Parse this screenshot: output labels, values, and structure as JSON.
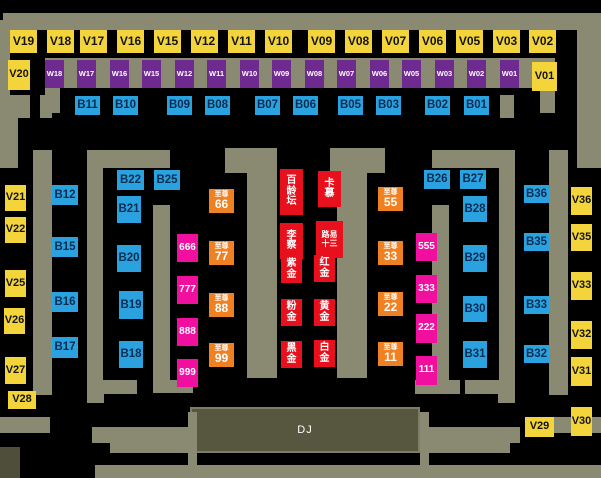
{
  "dj_booth": {
    "label": "DJ"
  },
  "colors": {
    "background": "#000000",
    "wall": "#8a8a73",
    "vip_yellow": "#f3d43b",
    "w_purple": "#6e2a8e",
    "b_blue": "#2aa2e0",
    "pink_magenta": "#f00f9e",
    "supreme_orange": "#f08122",
    "booth_red": "#e8101c",
    "dj_fill": "#57573f"
  },
  "tables": [
    {
      "label": "V19",
      "type": "vip",
      "x": 10,
      "y": 30,
      "w": 27,
      "h": 23
    },
    {
      "label": "V18",
      "type": "vip",
      "x": 47,
      "y": 30,
      "w": 27,
      "h": 23
    },
    {
      "label": "V17",
      "type": "vip",
      "x": 80,
      "y": 30,
      "w": 27,
      "h": 23
    },
    {
      "label": "V16",
      "type": "vip",
      "x": 117,
      "y": 30,
      "w": 27,
      "h": 23
    },
    {
      "label": "V15",
      "type": "vip",
      "x": 154,
      "y": 30,
      "w": 27,
      "h": 23
    },
    {
      "label": "V12",
      "type": "vip",
      "x": 191,
      "y": 30,
      "w": 27,
      "h": 23
    },
    {
      "label": "V11",
      "type": "vip",
      "x": 228,
      "y": 30,
      "w": 27,
      "h": 23
    },
    {
      "label": "V10",
      "type": "vip",
      "x": 265,
      "y": 30,
      "w": 27,
      "h": 23
    },
    {
      "label": "V09",
      "type": "vip",
      "x": 308,
      "y": 30,
      "w": 27,
      "h": 23
    },
    {
      "label": "V08",
      "type": "vip",
      "x": 345,
      "y": 30,
      "w": 27,
      "h": 23
    },
    {
      "label": "V07",
      "type": "vip",
      "x": 382,
      "y": 30,
      "w": 27,
      "h": 23
    },
    {
      "label": "V06",
      "type": "vip",
      "x": 419,
      "y": 30,
      "w": 27,
      "h": 23
    },
    {
      "label": "V05",
      "type": "vip",
      "x": 456,
      "y": 30,
      "w": 27,
      "h": 23
    },
    {
      "label": "V03",
      "type": "vip",
      "x": 493,
      "y": 30,
      "w": 27,
      "h": 23
    },
    {
      "label": "V02",
      "type": "vip",
      "x": 529,
      "y": 30,
      "w": 27,
      "h": 23
    },
    {
      "label": "V20",
      "type": "vips",
      "x": 8,
      "y": 60,
      "w": 22,
      "h": 30
    },
    {
      "label": "V01",
      "type": "vips",
      "x": 532,
      "y": 62,
      "w": 25,
      "h": 29
    },
    {
      "label": "W18",
      "type": "w",
      "x": 45,
      "y": 60,
      "w": 19,
      "h": 28
    },
    {
      "label": "W17",
      "type": "w",
      "x": 77,
      "y": 60,
      "w": 19,
      "h": 28
    },
    {
      "label": "W16",
      "type": "w",
      "x": 110,
      "y": 60,
      "w": 19,
      "h": 28
    },
    {
      "label": "W15",
      "type": "w",
      "x": 142,
      "y": 60,
      "w": 19,
      "h": 28
    },
    {
      "label": "W12",
      "type": "w",
      "x": 175,
      "y": 60,
      "w": 19,
      "h": 28
    },
    {
      "label": "W11",
      "type": "w",
      "x": 207,
      "y": 60,
      "w": 19,
      "h": 28
    },
    {
      "label": "W10",
      "type": "w",
      "x": 240,
      "y": 60,
      "w": 19,
      "h": 28
    },
    {
      "label": "W09",
      "type": "w",
      "x": 272,
      "y": 60,
      "w": 19,
      "h": 28
    },
    {
      "label": "W08",
      "type": "w",
      "x": 305,
      "y": 60,
      "w": 19,
      "h": 28
    },
    {
      "label": "W07",
      "type": "w",
      "x": 337,
      "y": 60,
      "w": 19,
      "h": 28
    },
    {
      "label": "W06",
      "type": "w",
      "x": 370,
      "y": 60,
      "w": 19,
      "h": 28
    },
    {
      "label": "W05",
      "type": "w",
      "x": 402,
      "y": 60,
      "w": 19,
      "h": 28
    },
    {
      "label": "W03",
      "type": "w",
      "x": 435,
      "y": 60,
      "w": 19,
      "h": 28
    },
    {
      "label": "W02",
      "type": "w",
      "x": 467,
      "y": 60,
      "w": 19,
      "h": 28
    },
    {
      "label": "W01",
      "type": "w",
      "x": 500,
      "y": 60,
      "w": 19,
      "h": 28
    },
    {
      "label": "B11",
      "type": "b",
      "x": 75,
      "y": 96,
      "w": 25,
      "h": 19
    },
    {
      "label": "B10",
      "type": "b",
      "x": 113,
      "y": 96,
      "w": 25,
      "h": 19
    },
    {
      "label": "B09",
      "type": "b",
      "x": 167,
      "y": 96,
      "w": 25,
      "h": 19
    },
    {
      "label": "B08",
      "type": "b",
      "x": 205,
      "y": 96,
      "w": 25,
      "h": 19
    },
    {
      "label": "B07",
      "type": "b",
      "x": 255,
      "y": 96,
      "w": 25,
      "h": 19
    },
    {
      "label": "B06",
      "type": "b",
      "x": 293,
      "y": 96,
      "w": 25,
      "h": 19
    },
    {
      "label": "B05",
      "type": "b",
      "x": 338,
      "y": 96,
      "w": 25,
      "h": 19
    },
    {
      "label": "B03",
      "type": "b",
      "x": 376,
      "y": 96,
      "w": 25,
      "h": 19
    },
    {
      "label": "B02",
      "type": "b",
      "x": 425,
      "y": 96,
      "w": 25,
      "h": 19
    },
    {
      "label": "B01",
      "type": "b",
      "x": 464,
      "y": 96,
      "w": 25,
      "h": 19
    },
    {
      "label": "V21",
      "type": "vips",
      "x": 5,
      "y": 185,
      "w": 21,
      "h": 26
    },
    {
      "label": "V22",
      "type": "vips",
      "x": 5,
      "y": 217,
      "w": 21,
      "h": 26
    },
    {
      "label": "V25",
      "type": "vips",
      "x": 5,
      "y": 270,
      "w": 21,
      "h": 27
    },
    {
      "label": "V26",
      "type": "vips",
      "x": 4,
      "y": 308,
      "w": 21,
      "h": 26
    },
    {
      "label": "V27",
      "type": "vips",
      "x": 5,
      "y": 357,
      "w": 21,
      "h": 27
    },
    {
      "label": "V28",
      "type": "vips",
      "x": 8,
      "y": 391,
      "w": 28,
      "h": 18
    },
    {
      "label": "B12",
      "type": "b",
      "x": 52,
      "y": 185,
      "w": 26,
      "h": 20
    },
    {
      "label": "B15",
      "type": "b",
      "x": 52,
      "y": 237,
      "w": 26,
      "h": 20
    },
    {
      "label": "B16",
      "type": "b",
      "x": 52,
      "y": 292,
      "w": 26,
      "h": 20
    },
    {
      "label": "B17",
      "type": "b",
      "x": 52,
      "y": 337,
      "w": 26,
      "h": 21
    },
    {
      "label": "B22",
      "type": "b",
      "x": 117,
      "y": 170,
      "w": 27,
      "h": 20
    },
    {
      "label": "B25",
      "type": "b",
      "x": 154,
      "y": 170,
      "w": 26,
      "h": 20
    },
    {
      "label": "B21",
      "type": "b",
      "x": 117,
      "y": 196,
      "w": 24,
      "h": 27
    },
    {
      "label": "B20",
      "type": "b",
      "x": 117,
      "y": 245,
      "w": 24,
      "h": 27
    },
    {
      "label": "B19",
      "type": "b",
      "x": 119,
      "y": 291,
      "w": 24,
      "h": 28
    },
    {
      "label": "B18",
      "type": "b",
      "x": 119,
      "y": 341,
      "w": 24,
      "h": 27
    },
    {
      "label": "666",
      "type": "pink",
      "x": 177,
      "y": 234,
      "w": 21,
      "h": 28
    },
    {
      "label": "777",
      "type": "pink",
      "x": 177,
      "y": 276,
      "w": 21,
      "h": 28
    },
    {
      "label": "888",
      "type": "pink",
      "x": 177,
      "y": 318,
      "w": 21,
      "h": 28
    },
    {
      "label": "999",
      "type": "pink",
      "x": 177,
      "y": 359,
      "w": 21,
      "h": 28
    },
    {
      "label": "至尊66",
      "type": "sup",
      "prefix": "至尊",
      "num": "66",
      "x": 209,
      "y": 189,
      "w": 25,
      "h": 24
    },
    {
      "label": "至尊77",
      "type": "sup",
      "prefix": "至尊",
      "num": "77",
      "x": 209,
      "y": 241,
      "w": 25,
      "h": 24
    },
    {
      "label": "至尊88",
      "type": "sup",
      "prefix": "至尊",
      "num": "88",
      "x": 209,
      "y": 293,
      "w": 25,
      "h": 24
    },
    {
      "label": "至尊99",
      "type": "sup",
      "prefix": "至尊",
      "num": "99",
      "x": 209,
      "y": 343,
      "w": 25,
      "h": 24
    },
    {
      "label": "百龄坛",
      "type": "red",
      "lines": [
        "百",
        "龄",
        "坛"
      ],
      "x": 280,
      "y": 169,
      "w": 23,
      "h": 46
    },
    {
      "label": "卡慕",
      "type": "red",
      "lines": [
        "卡",
        "慕"
      ],
      "x": 318,
      "y": 171,
      "w": 23,
      "h": 36
    },
    {
      "label": "李察",
      "type": "red",
      "lines": [
        "李",
        "察"
      ],
      "x": 280,
      "y": 223,
      "w": 23,
      "h": 36
    },
    {
      "label": "路易十三",
      "type": "red small",
      "lines": [
        "路易",
        "十三"
      ],
      "x": 316,
      "y": 221,
      "w": 27,
      "h": 37
    },
    {
      "label": "紫金",
      "type": "red",
      "lines": [
        "紫",
        "金"
      ],
      "x": 281,
      "y": 256,
      "w": 21,
      "h": 27
    },
    {
      "label": "红金",
      "type": "red",
      "lines": [
        "红",
        "金"
      ],
      "x": 314,
      "y": 255,
      "w": 21,
      "h": 27
    },
    {
      "label": "粉金",
      "type": "red",
      "lines": [
        "粉",
        "金"
      ],
      "x": 281,
      "y": 299,
      "w": 21,
      "h": 27
    },
    {
      "label": "黄金",
      "type": "red",
      "lines": [
        "黄",
        "金"
      ],
      "x": 314,
      "y": 299,
      "w": 21,
      "h": 27
    },
    {
      "label": "黑金",
      "type": "red",
      "lines": [
        "黑",
        "金"
      ],
      "x": 281,
      "y": 341,
      "w": 21,
      "h": 27
    },
    {
      "label": "白金",
      "type": "red",
      "lines": [
        "白",
        "金"
      ],
      "x": 314,
      "y": 340,
      "w": 21,
      "h": 27
    },
    {
      "label": "至尊55",
      "type": "sup",
      "prefix": "至尊",
      "num": "55",
      "x": 378,
      "y": 187,
      "w": 25,
      "h": 24
    },
    {
      "label": "至尊33",
      "type": "sup",
      "prefix": "至尊",
      "num": "33",
      "x": 378,
      "y": 241,
      "w": 25,
      "h": 24
    },
    {
      "label": "至尊22",
      "type": "sup",
      "prefix": "至尊",
      "num": "22",
      "x": 378,
      "y": 292,
      "w": 25,
      "h": 24
    },
    {
      "label": "至尊11",
      "type": "sup",
      "prefix": "至尊",
      "num": "11",
      "x": 378,
      "y": 342,
      "w": 25,
      "h": 24
    },
    {
      "label": "555",
      "type": "pink",
      "x": 416,
      "y": 233,
      "w": 21,
      "h": 28
    },
    {
      "label": "333",
      "type": "pink",
      "x": 416,
      "y": 275,
      "w": 21,
      "h": 28
    },
    {
      "label": "222",
      "type": "pink",
      "x": 416,
      "y": 314,
      "w": 21,
      "h": 29
    },
    {
      "label": "111",
      "type": "pink",
      "x": 416,
      "y": 356,
      "w": 21,
      "h": 29
    },
    {
      "label": "B26",
      "type": "b",
      "x": 424,
      "y": 170,
      "w": 26,
      "h": 19
    },
    {
      "label": "B27",
      "type": "b",
      "x": 460,
      "y": 170,
      "w": 26,
      "h": 19
    },
    {
      "label": "B28",
      "type": "b",
      "x": 463,
      "y": 196,
      "w": 24,
      "h": 26
    },
    {
      "label": "B29",
      "type": "b",
      "x": 463,
      "y": 245,
      "w": 24,
      "h": 27
    },
    {
      "label": "B30",
      "type": "b",
      "x": 463,
      "y": 296,
      "w": 24,
      "h": 26
    },
    {
      "label": "B31",
      "type": "b",
      "x": 463,
      "y": 341,
      "w": 24,
      "h": 27
    },
    {
      "label": "B36",
      "type": "b",
      "x": 524,
      "y": 185,
      "w": 25,
      "h": 18
    },
    {
      "label": "B35",
      "type": "b",
      "x": 524,
      "y": 233,
      "w": 25,
      "h": 18
    },
    {
      "label": "B33",
      "type": "b",
      "x": 524,
      "y": 296,
      "w": 25,
      "h": 18
    },
    {
      "label": "B32",
      "type": "b",
      "x": 524,
      "y": 345,
      "w": 25,
      "h": 18
    },
    {
      "label": "V36",
      "type": "vips",
      "x": 571,
      "y": 187,
      "w": 21,
      "h": 28
    },
    {
      "label": "V35",
      "type": "vips",
      "x": 571,
      "y": 224,
      "w": 21,
      "h": 27
    },
    {
      "label": "V33",
      "type": "vips",
      "x": 571,
      "y": 272,
      "w": 21,
      "h": 28
    },
    {
      "label": "V32",
      "type": "vips",
      "x": 571,
      "y": 321,
      "w": 21,
      "h": 28
    },
    {
      "label": "V31",
      "type": "vips",
      "x": 571,
      "y": 357,
      "w": 21,
      "h": 29
    },
    {
      "label": "V30",
      "type": "vips",
      "x": 571,
      "y": 407,
      "w": 21,
      "h": 29
    },
    {
      "label": "V29",
      "type": "vips",
      "x": 525,
      "y": 417,
      "w": 29,
      "h": 20
    }
  ],
  "floor_plan": {
    "dj": {
      "x": 190,
      "y": 407,
      "w": 230,
      "h": 46
    },
    "walls": [
      [
        3,
        13,
        594,
        17
      ],
      [
        0,
        20,
        10,
        98
      ],
      [
        0,
        95,
        30,
        23
      ],
      [
        40,
        95,
        12,
        23
      ],
      [
        0,
        118,
        18,
        50
      ],
      [
        577,
        13,
        24,
        155
      ],
      [
        500,
        95,
        14,
        23
      ],
      [
        45,
        58,
        510,
        30
      ],
      [
        45,
        88,
        15,
        25
      ],
      [
        540,
        88,
        15,
        25
      ],
      [
        0,
        150,
        18,
        18
      ],
      [
        33,
        150,
        19,
        245
      ],
      [
        87,
        150,
        83,
        18
      ],
      [
        87,
        168,
        16,
        212
      ],
      [
        87,
        380,
        50,
        14
      ],
      [
        87,
        380,
        17,
        23
      ],
      [
        153,
        205,
        17,
        175
      ],
      [
        153,
        380,
        40,
        13
      ],
      [
        225,
        148,
        52,
        25
      ],
      [
        247,
        173,
        30,
        205
      ],
      [
        330,
        148,
        55,
        25
      ],
      [
        337,
        173,
        30,
        205
      ],
      [
        432,
        205,
        17,
        175
      ],
      [
        415,
        380,
        45,
        14
      ],
      [
        432,
        150,
        83,
        18
      ],
      [
        499,
        168,
        16,
        212
      ],
      [
        465,
        380,
        50,
        14
      ],
      [
        498,
        380,
        17,
        23
      ],
      [
        549,
        150,
        19,
        245
      ],
      [
        0,
        417,
        50,
        16
      ],
      [
        551,
        417,
        50,
        16
      ],
      [
        92,
        427,
        96,
        16
      ],
      [
        110,
        443,
        78,
        10
      ],
      [
        420,
        427,
        100,
        16
      ],
      [
        420,
        443,
        90,
        10
      ],
      [
        188,
        412,
        9,
        53
      ],
      [
        420,
        412,
        9,
        53
      ],
      [
        95,
        465,
        506,
        13
      ]
    ],
    "dark_blocks": [
      [
        0,
        447,
        20,
        31
      ]
    ]
  }
}
